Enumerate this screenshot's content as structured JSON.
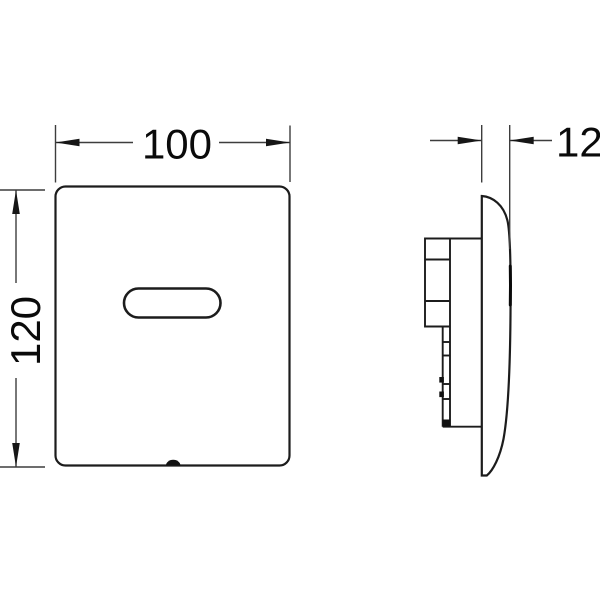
{
  "drawing": {
    "type": "technical dimension drawing",
    "subject": "electronic sensor flush plate, front and side view",
    "background": "#ffffff",
    "outline_color": "#1c1c1c",
    "dimension_line_color": "#3d3d3d",
    "text_color": "#0a0a0a",
    "views": {
      "front": {
        "name": "front view",
        "width_label": "100",
        "height_label": "120"
      },
      "side": {
        "name": "side view",
        "depth_label": "12"
      }
    }
  }
}
